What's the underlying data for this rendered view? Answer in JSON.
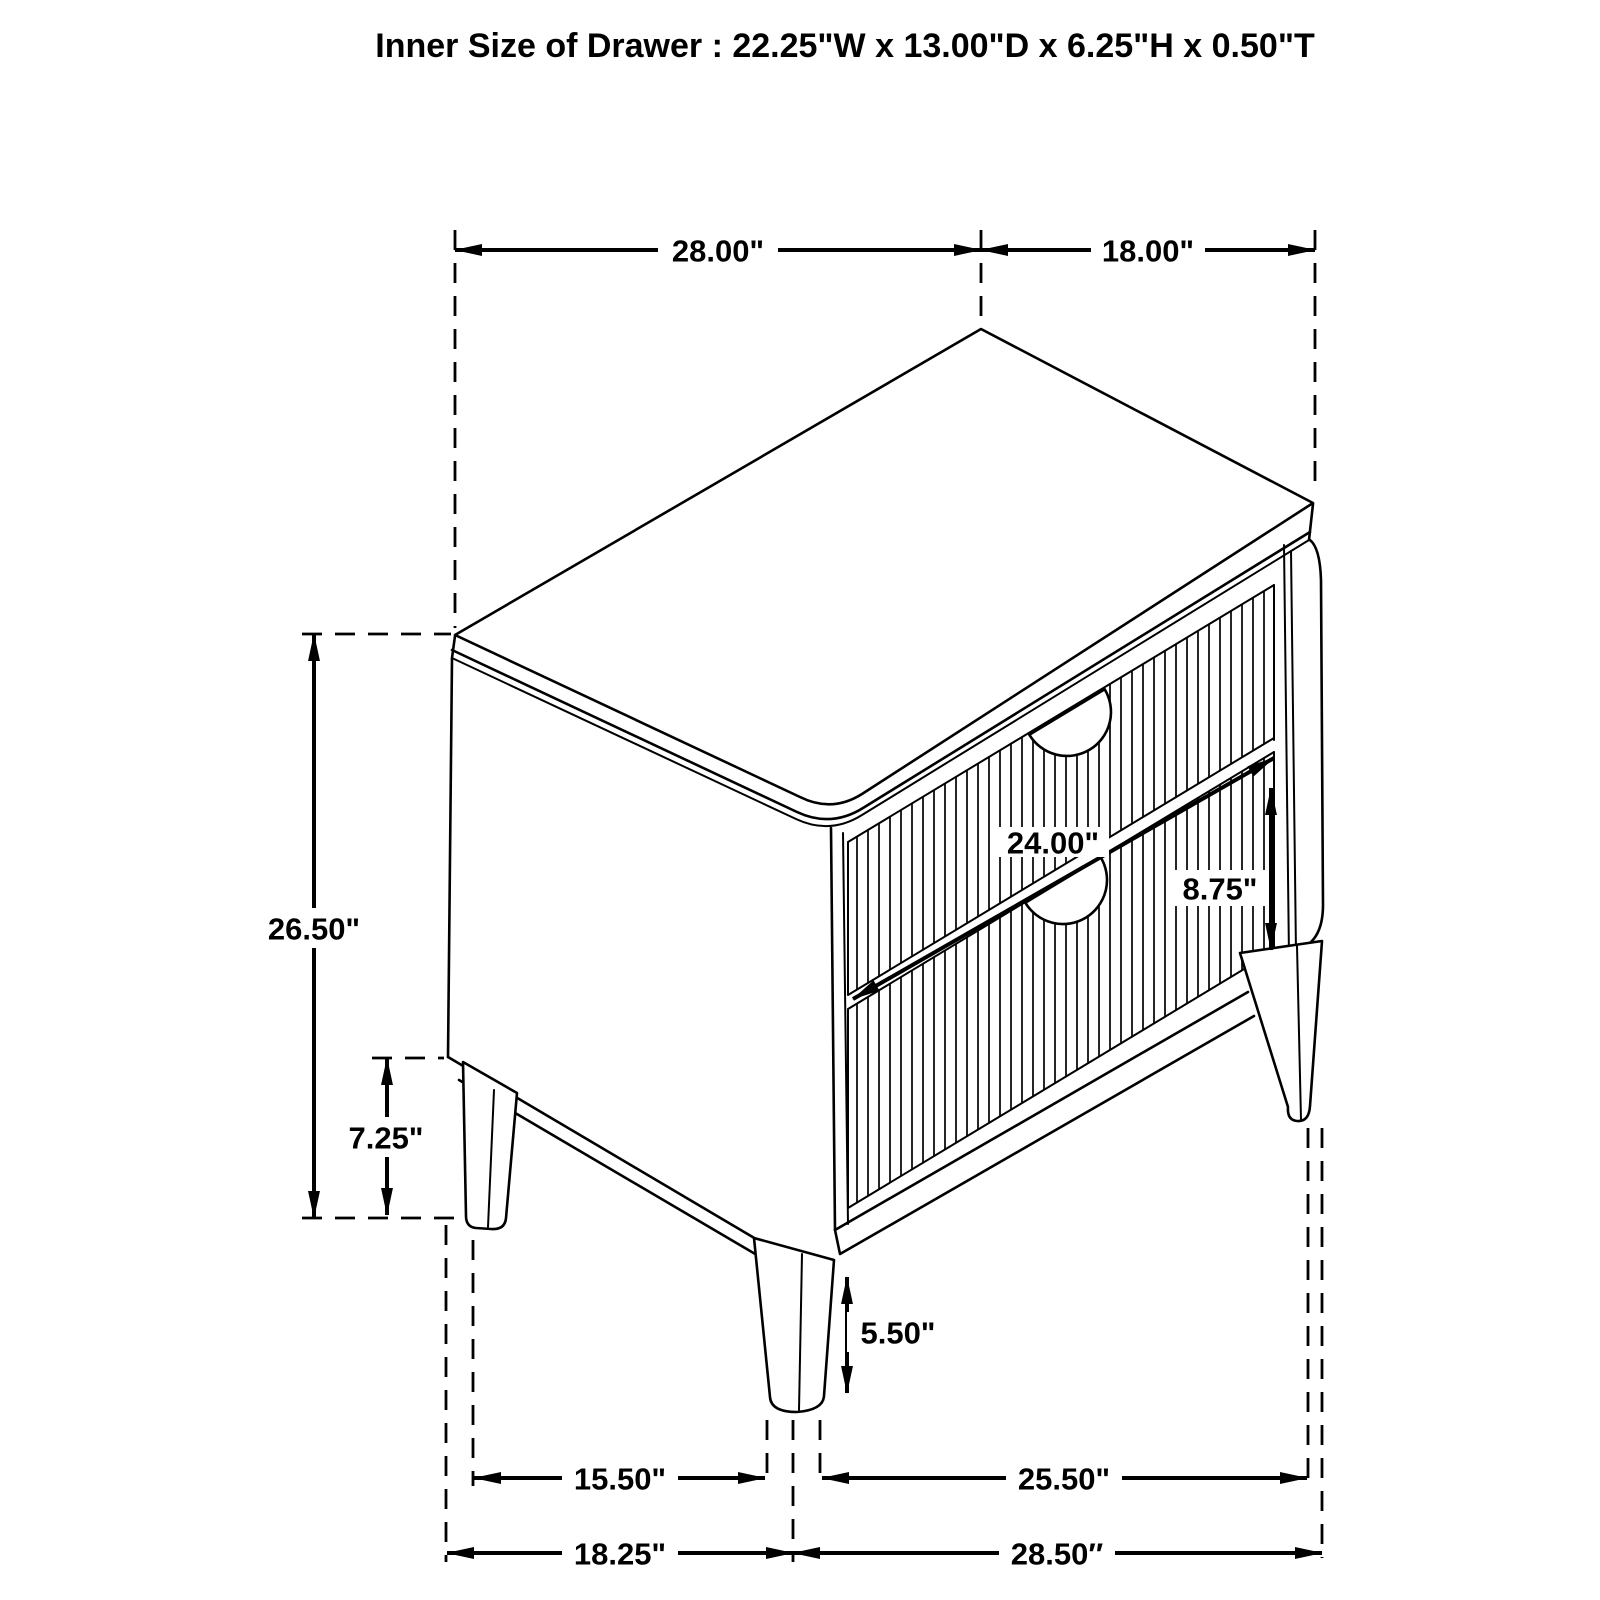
{
  "title": "Inner Size of Drawer : 22.25\"W x 13.00\"D x 6.25\"H x 0.50\"T",
  "dims": {
    "top_span_left": "28.00\"",
    "top_span_right": "18.00\"",
    "overall_height": "26.50\"",
    "base_clearance": "7.25\"",
    "drawer_width": "24.00\"",
    "drawer_stack_height": "8.75\"",
    "front_leg_height": "5.50\"",
    "foot_span_left": "15.50\"",
    "foot_span_right": "25.50\"",
    "base_span_left": "18.25\"",
    "base_span_right": "28.50″"
  },
  "colors": {
    "ink": "#000000",
    "background": "#ffffff"
  }
}
